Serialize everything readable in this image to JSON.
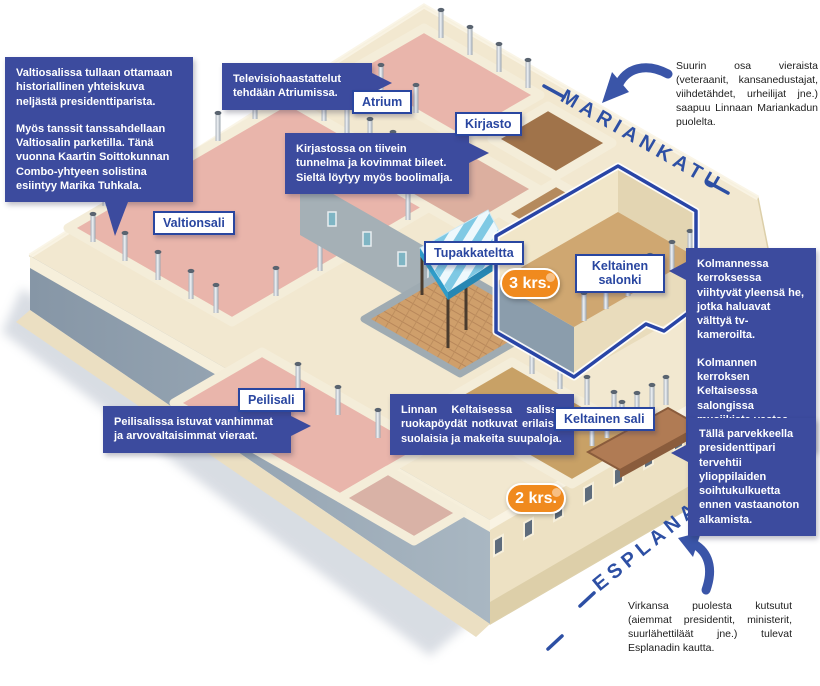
{
  "callouts": {
    "valtiosali": {
      "p1": "Valtiosalissa tullaan ottamaan historiallinen yhteiskuva neljästä presidenttiparista.",
      "p2": "Myös tanssit tanssahdellaan Valtiosalin parketilla. Tänä vuonna Kaartin Soittokunnan Combo-yhtyeen solistina esiintyy ",
      "p2_bold": "Marika Tuhkala."
    },
    "atrium": {
      "text": "Televisiohaastattelut tehdään Atriumissa."
    },
    "kirjasto": {
      "text": "Kirjastossa on tiivein tunnelma ja kovimmat bileet. Sieltä löytyy myös boolimalja."
    },
    "kolmas_kerros": {
      "p1": "Kolmannessa kerroksessa viihtyvät yleensä he, jotka haluavat välttyä tv-kameroilta.",
      "p2": "Kolmannen kerroksen Keltaisessa salongissa musiikista vastaa ",
      "p2_bold": "Saaga Ensemble",
      "p2_end": "."
    },
    "peilisali": {
      "text": "Peilisalissa istuvat vanhimmat ja arvovaltaisimmat vieraat."
    },
    "keltainen_sali": {
      "text": "Linnan Keltaisessa salissa ruokapöydät notkuvat erilaisia suolaisia ja makeita suupaloja."
    },
    "parveke": {
      "text": "Tällä parvekkeella presidenttipari tervehtii ylioppilaiden soihtukulkuetta ennen vastaanoton alkamista."
    }
  },
  "room_labels": {
    "atrium": "Atrium",
    "kirjasto": "Kirjasto",
    "valtionsali": "Valtionsali",
    "tupakkateltta": "Tupakkateltta",
    "keltainen_salonki": "Keltainen salonki",
    "peilisali": "Peilisali",
    "keltainen_sali": "Keltainen sali"
  },
  "badges": {
    "third_floor": "3 krs.",
    "second_floor": "2 krs."
  },
  "streets": {
    "mariankatu": "MARIANKATU",
    "esplanadi": "ESPLANADI"
  },
  "notes": {
    "mariankatu_entry": "Suurin osa vieraista (veteraanit, kansanedustajat, viihdetähdet, urheilijat jne.) saapuu Linnaan Mariankadun puolelta.",
    "esplanadi_entry": "Virkansa puolesta kutsutut (aiemmat presidentit, ministerit, suurlähettiläät jne.) tulevat Esplanadin kautta."
  },
  "colors": {
    "callout_bg": "#3c4b9e",
    "label_blue": "#2946a0",
    "street_blue": "#2d4fa4",
    "badge_orange": "#f08a1e",
    "floor_pink": "#e9b5ab",
    "floor_tan": "#c99c68",
    "wall_cream": "#f1e7cd",
    "shadow_wall": "#8b9dac",
    "canopy_blue": "#7fc9e4",
    "outline_blue": "#2945a6"
  }
}
